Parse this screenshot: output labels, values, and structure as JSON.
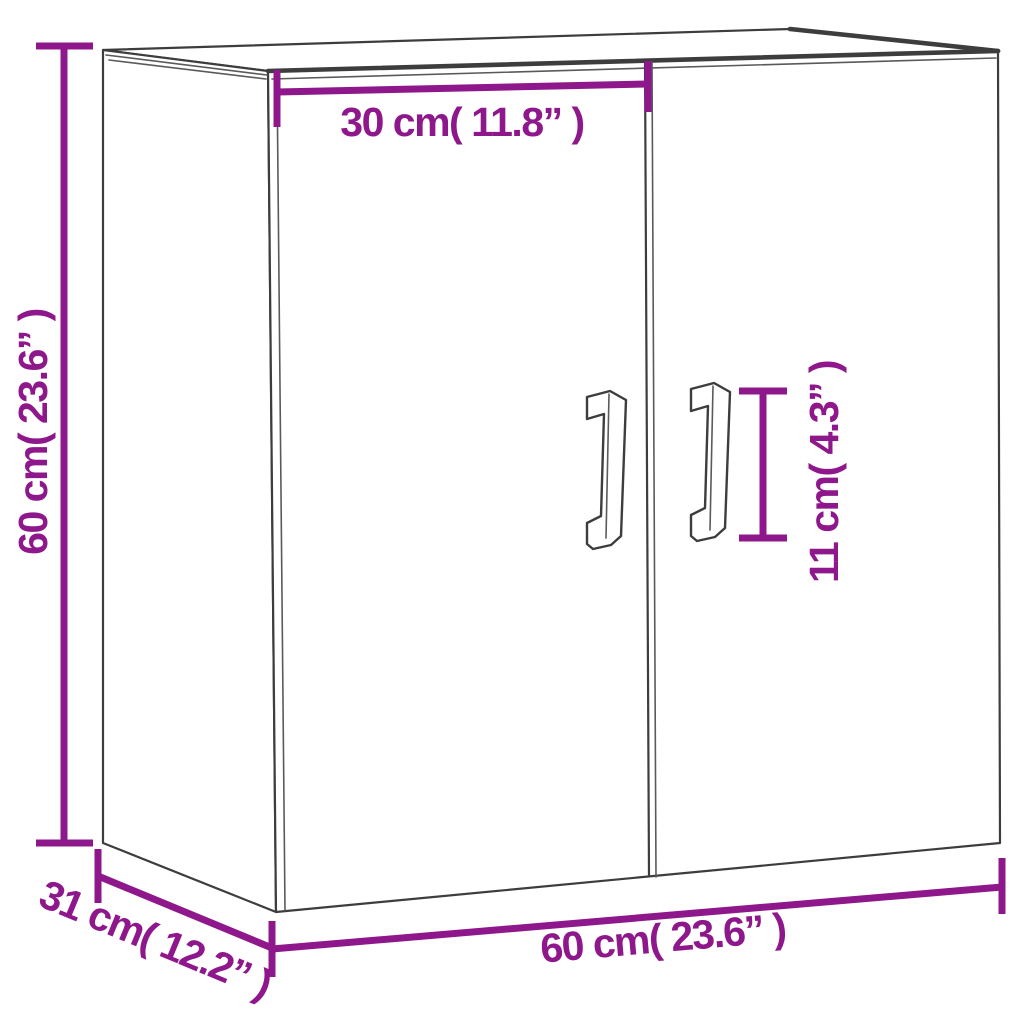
{
  "diagram": {
    "title": "wall-cabinet-dimension-diagram",
    "accent_color": "#8E188B",
    "outline_color": "#3d3d3d",
    "background_color": "#ffffff",
    "dimensions": {
      "cabinet_height": {
        "label": "60 cm( 23.6” )",
        "value_cm": 60,
        "value_inch": 23.6
      },
      "door_width": {
        "label": "30 cm( 11.8” )",
        "value_cm": 30,
        "value_inch": 11.8
      },
      "handle_height": {
        "label": "11 cm( 4.3” )",
        "value_cm": 11,
        "value_inch": 4.3
      },
      "cabinet_depth": {
        "label": "31 cm( 12.2” )",
        "value_cm": 31,
        "value_inch": 12.2
      },
      "cabinet_width": {
        "label": "60 cm( 23.6” )",
        "value_cm": 60,
        "value_inch": 23.6
      }
    }
  }
}
